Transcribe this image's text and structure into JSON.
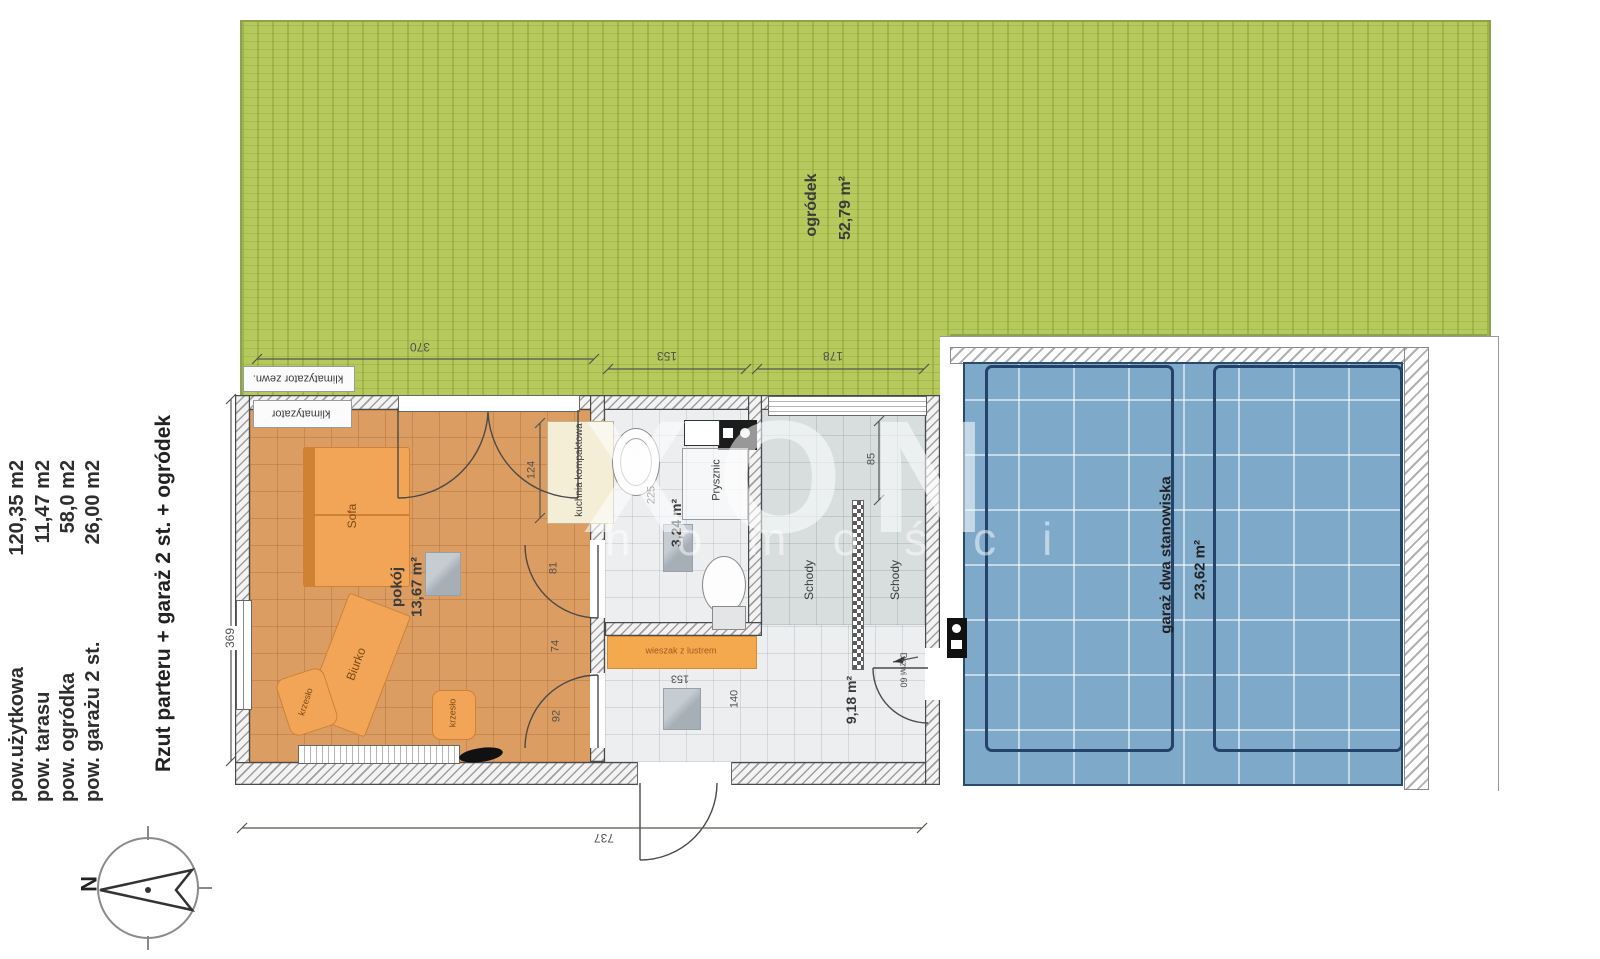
{
  "title_block": {
    "rows": [
      {
        "label": "pow.użytkowa",
        "value": "120,35 m2"
      },
      {
        "label": "pow. tarasu",
        "value": "11,47 m2"
      },
      {
        "label": "pow. ogródka",
        "value": "58,0 m2"
      },
      {
        "label": "pow. garażu 2 st.",
        "value": "26,00 m2"
      }
    ],
    "plan_title": "Rzut parteru  + garaż 2 st. + ogródek"
  },
  "areas": {
    "garden": {
      "name": "ogródek",
      "area": "52,79 m²"
    },
    "garage": {
      "name": "garaż dwa stanowiska",
      "area": "23,62 m²"
    },
    "room": {
      "name": "pokój",
      "area": "13,67 m²"
    },
    "bathroom": {
      "area": "3,24 m²",
      "shower": "Prysznic"
    },
    "hall": {
      "area": "9,18 m²"
    },
    "stairs": {
      "name": "Schody"
    },
    "kitchen": {
      "name": "kuchnia kompaktowa"
    }
  },
  "furniture": {
    "sofa": "Sofa",
    "desk": "Biurko",
    "chair": "krzesło",
    "hanger": "wieszak z lustrem"
  },
  "equipment": {
    "ac_indoor": "klimatyzator",
    "ac_outdoor": "klimatyzator zewn."
  },
  "dimensions": {
    "garden_w": "370",
    "bath_top": "153",
    "stairs_top": "178",
    "room_h": "369",
    "house_w": "737",
    "kitchen": "124",
    "bath_h": "225",
    "seg81": "81",
    "seg74": "74",
    "door92": "92",
    "hall140": "140",
    "hall153": "153",
    "stairs85": "85",
    "garage_door": "Drzwi 60"
  },
  "compass": {
    "north": "N"
  },
  "watermark": {
    "big": "XON",
    "small": "homości"
  },
  "colors": {
    "garden": "#b5c95c",
    "garage_floor": "#7fa9c9",
    "room_floor": "#dc9d62",
    "furniture": "#f2a557"
  }
}
